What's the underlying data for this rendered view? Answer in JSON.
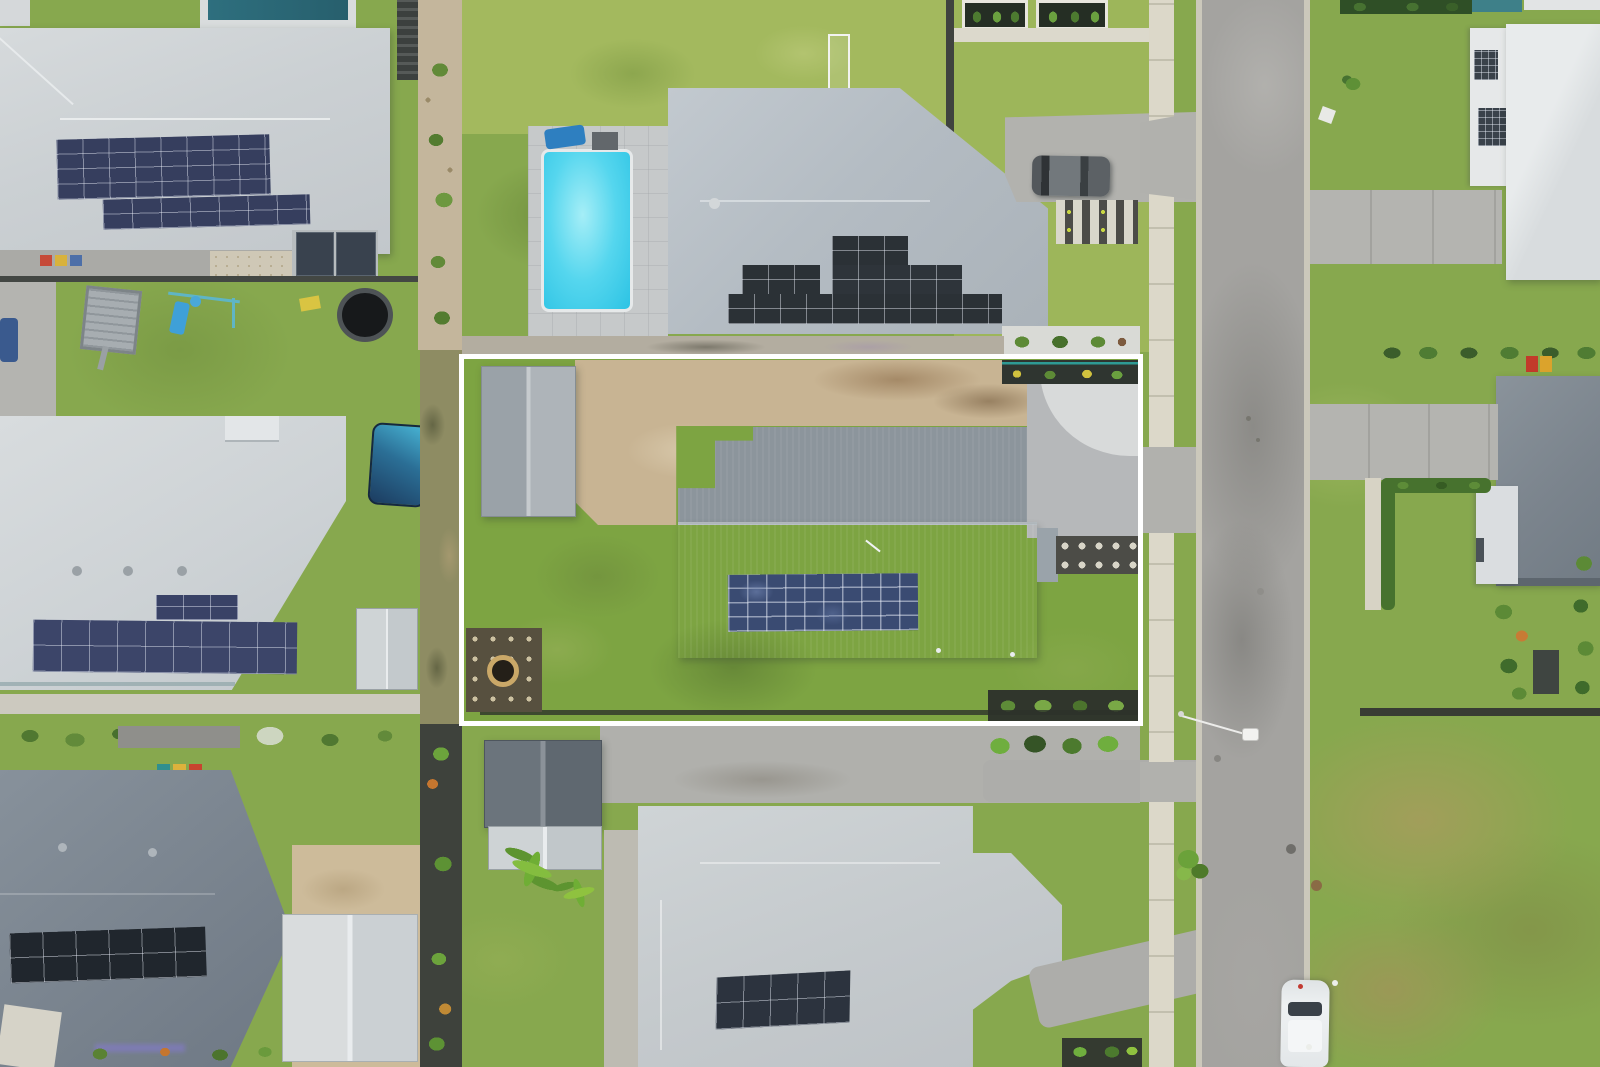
{
  "scene": {
    "type": "aerial-drone-photograph",
    "description": "Top-down drone photo of a suburban street; the subject lot is outlined with a white rectangle and contains a grey-roofed house with a rooftop solar array, a shed, a dirt yard area and lawns. Neighbouring lots show pools, solar roofs, sheds, trampolines, driveways and a vertical asphalt road on the right with parked cars.",
    "highlight_box": {
      "name": "property-boundary",
      "color": "#ffffff",
      "x": 459,
      "y": 354,
      "width": 684,
      "height": 372,
      "stroke_px": 5
    },
    "palette": {
      "lawn": "#87a84e",
      "lawn_light": "#b2c470",
      "lawn_dark": "#5e8434",
      "road": "#a4a3a0",
      "kerb": "#cbc8bb",
      "footpath": "#dcd8c9",
      "driveway": "#b2b2ae",
      "dirt": "#c8b493",
      "gravel": "#b6b8ba",
      "pebble_white": "#d8dada",
      "roof_white": "#ccd1d4",
      "roof_mid_grey": "#9aa3aa",
      "roof_dark_grey": "#79838e",
      "solar_blue": "#3a4b72",
      "solar_black": "#2b3136",
      "pool_cyan": "#4fd2ec",
      "hedge_green": "#47722e",
      "boundary_white": "#ffffff"
    },
    "objects": [
      {
        "name": "subject-house-roof",
        "note": "two-tone grey roof inside white boundary"
      },
      {
        "name": "subject-solar-array",
        "note": "4 x 10 blue solar panels"
      },
      {
        "name": "subject-shed",
        "note": "grey gable shed top-left of lot"
      },
      {
        "name": "subject-dirt-yard",
        "note": "bare tan earth area"
      },
      {
        "name": "subject-paver-patio",
        "note": "dark pavers with fire pit"
      },
      {
        "name": "pool-neighbour-roof",
        "note": "grey roof with stepped black solar blocks"
      },
      {
        "name": "swimming-pool",
        "note": "cyan rectangular pool with grey surround"
      },
      {
        "name": "soccer-goal",
        "note": "white goal frame on back lawn"
      },
      {
        "name": "suv-on-driveway",
        "note": "dark grey SUV"
      },
      {
        "name": "white-car-on-road",
        "note": "white hatchback parked on kerb bottom right"
      },
      {
        "name": "street-light",
        "note": "lamp arm over road"
      },
      {
        "name": "trampoline",
        "note": "black round trampoline"
      },
      {
        "name": "box-trailer",
        "note": "grey cage trailer"
      },
      {
        "name": "swing-set",
        "note": "play set with blue slide"
      },
      {
        "name": "spa-cover",
        "note": "blue covered spa"
      },
      {
        "name": "road",
        "note": "vertical asphalt street with concrete gutters"
      },
      {
        "name": "footpath",
        "note": "concrete path west of road"
      },
      {
        "name": "solar-roof-houses",
        "note": "multiple neighbouring roofs with PV arrays"
      },
      {
        "name": "palm-trees",
        "note": "bright green palms below subject lot"
      },
      {
        "name": "hedges-and-garden-beds",
        "note": "dark green landscaping rows"
      }
    ]
  }
}
